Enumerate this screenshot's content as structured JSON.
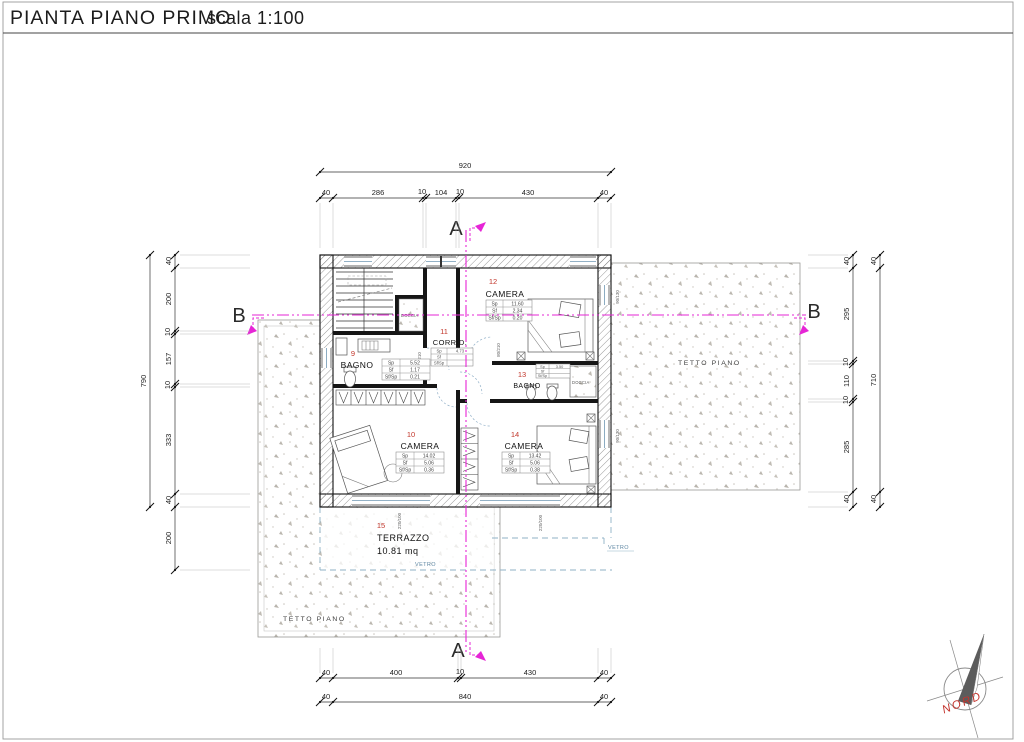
{
  "title": {
    "main": "PIANTA PIANO PRIMO",
    "scale": "scala 1:100"
  },
  "sections": {
    "a": "A",
    "b": "B"
  },
  "labels": {
    "tetto_right": "TETTO PIANO",
    "tetto_left": "TETTO PIANO",
    "vetro_front": "VETRO",
    "vetro_right": "VETRO",
    "doccia_top": "DOCCIA",
    "doccia_bagno13": "DOCCIA",
    "nord": "NORD"
  },
  "rooms": {
    "bagno9": {
      "num": "9",
      "name": "BAGNO",
      "rows": [
        [
          "Sp",
          "5.52"
        ],
        [
          "Sf",
          "1.17"
        ],
        [
          "Sf/Sp",
          "0.21"
        ]
      ]
    },
    "camera10": {
      "num": "10",
      "name": "CAMERA",
      "rows": [
        [
          "Sp",
          "14.02"
        ],
        [
          "Sf",
          "5.06"
        ],
        [
          "Sf/Sp",
          "0.36"
        ]
      ]
    },
    "corridoio": {
      "num": "11",
      "name": "CORRID.",
      "rows": [
        [
          "Sp",
          "4.73"
        ],
        [
          "Sf",
          ""
        ],
        [
          "Sf/Sp",
          ""
        ]
      ]
    },
    "camera12": {
      "num": "12",
      "name": "CAMERA",
      "rows": [
        [
          "Sp",
          "11.60"
        ],
        [
          "Sf",
          "2.34"
        ],
        [
          "Sf/Sp",
          "0.20"
        ]
      ]
    },
    "bagno13": {
      "num": "13",
      "name": "BAGNO",
      "rows": [
        [
          "Sp",
          "3.50"
        ],
        [
          "Sf",
          ""
        ],
        [
          "Sf/Sp",
          ""
        ]
      ]
    },
    "camera14": {
      "num": "14",
      "name": "CAMERA",
      "rows": [
        [
          "Sp",
          "13.42"
        ],
        [
          "Sf",
          "5.06"
        ],
        [
          "Sf/Sp",
          "0.38"
        ]
      ]
    },
    "terrazzo": {
      "num": "15",
      "name": "TERRAZZO",
      "area": "10.81 mq"
    }
  },
  "tags": {
    "door_left": "80/210",
    "door_right": "80/210",
    "window_right_top": "90/130",
    "window_right_bottom": "90/130",
    "glass_door_left": "220/100",
    "glass_door_right": "220/100"
  },
  "dims": {
    "top": {
      "total": "920",
      "chain": [
        "40",
        "286",
        "10",
        "104",
        "10",
        "430",
        "40"
      ]
    },
    "bottom": {
      "chain": [
        "40",
        "400",
        "10",
        "430",
        "40"
      ],
      "total": [
        "40",
        "840",
        "40"
      ]
    },
    "left": {
      "total": "790",
      "chain": [
        "40",
        "200",
        "10",
        "157",
        "10",
        "333",
        "40",
        "200"
      ]
    },
    "right": {
      "chain": [
        "40",
        "295",
        "10",
        "110",
        "10",
        "285",
        "40"
      ],
      "total": [
        "40",
        "710",
        "40"
      ]
    }
  }
}
